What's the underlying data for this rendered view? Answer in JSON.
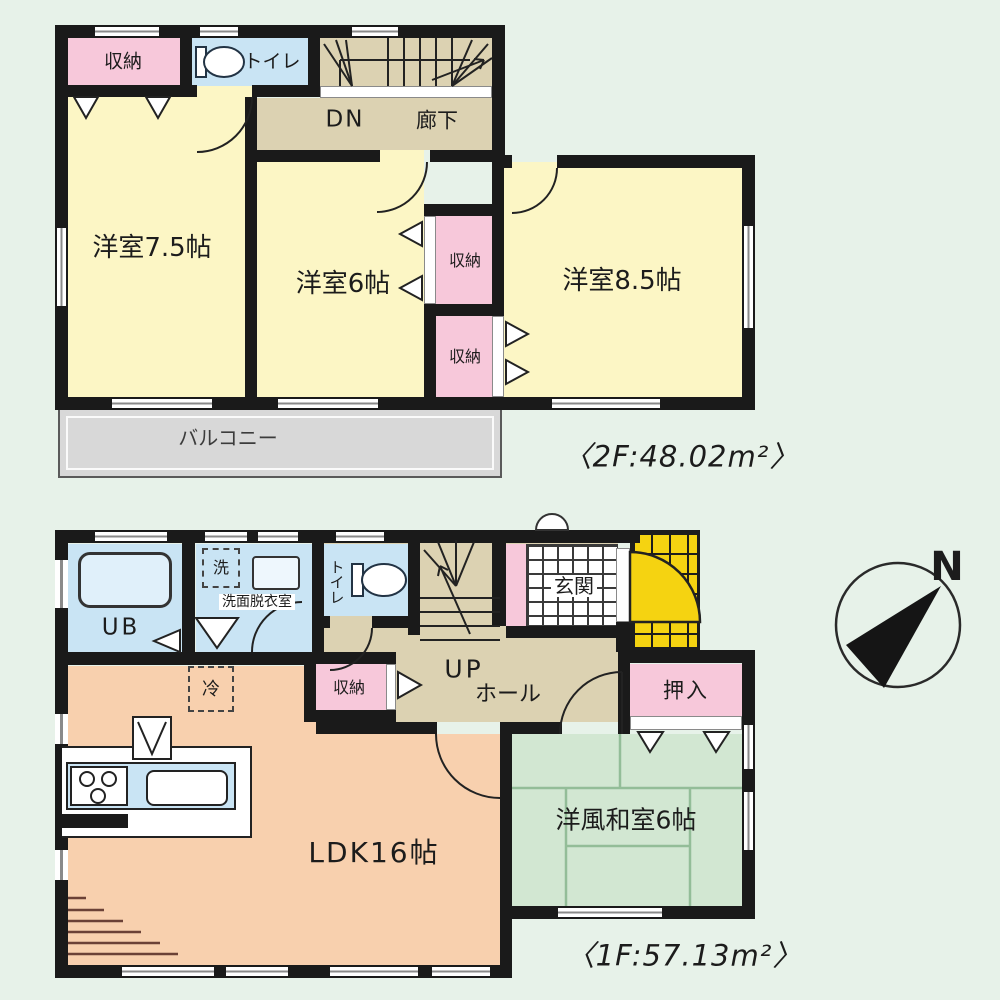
{
  "floor2": {
    "area_label": "〈2F:48.02m²〉",
    "rooms": {
      "closet": "収納",
      "toilet": "トイレ",
      "down": "DN",
      "hallway": "廊下",
      "western_room_75": "洋室7.5帖",
      "western_room_6": "洋室6帖",
      "western_room_85": "洋室8.5帖",
      "balcony": "バルコニー"
    }
  },
  "floor1": {
    "area_label": "〈1F:57.13m²〉",
    "rooms": {
      "unit_bath": "UB",
      "washer": "洗",
      "washroom": "洗面脱衣室",
      "toilet": "トイレ",
      "entrance": "玄関",
      "up": "UP",
      "hall": "ホール",
      "closet": "収納",
      "oshiire": "押入",
      "fridge": "冷",
      "ldk": "LDK16帖",
      "japanese_room": "洋風和室6帖"
    }
  },
  "compass": {
    "north": "N"
  },
  "colors": {
    "background": "#e7f2e9",
    "wall": "#1a1a1a",
    "room_yellow": "#fcf6c5",
    "closet_pink": "#f7c8da",
    "water_blue": "#c9e4f4",
    "corridor_beige": "#dcd2b2",
    "balcony_gray": "#d8d8d8",
    "ldk_salmon": "#f8d0ae",
    "tatami_green": "#d2e7d2",
    "porch_yellow": "#f5d311"
  }
}
